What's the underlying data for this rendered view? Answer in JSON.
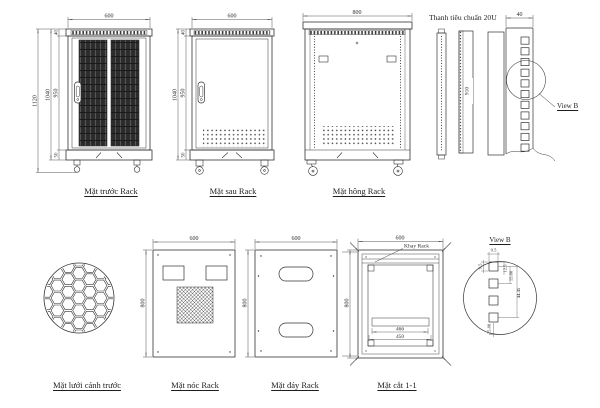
{
  "views": {
    "front": {
      "label": "Mặt trước Rack",
      "dim_width": "600",
      "dim_overall_height": "1120",
      "dim_body_height": "1040",
      "dim_door_height": "950",
      "dim_top_panel": "40",
      "dim_bottom_panel": "50"
    },
    "back": {
      "label": "Mặt sau Rack",
      "dim_width": "600",
      "dim_body_height": "1040",
      "dim_door_height": "950",
      "dim_top_panel": "40",
      "dim_bottom_panel": "50"
    },
    "side": {
      "label": "Mặt hông Rack",
      "dim_depth": "800"
    },
    "rail": {
      "title": "Thanh tiêu chuẩn 20U",
      "dim_flange_width": "40",
      "dim_height": "910",
      "detail_callout": "View B"
    },
    "mesh": {
      "label": "Mặt lưới cánh trước"
    },
    "roof": {
      "label": "Mặt nóc Rack",
      "dim_width": "600",
      "dim_depth": "800"
    },
    "base": {
      "label": "Mặt đáy Rack",
      "dim_width": "600",
      "dim_depth": "800"
    },
    "section": {
      "label": "Mặt cắt 1-1",
      "tray_callout": "Khay Rack",
      "dim_width": "600",
      "dim_depth": "800",
      "dim_rail_outer": "466",
      "dim_rail_inner": "450"
    },
    "detail_b": {
      "title": "View B",
      "dim_hole_width": "9.5",
      "dim_hole_height": "9.5",
      "dim_top_offset": "12.5",
      "dim_hole_pitch": "15.88",
      "dim_u_pitch": "44.45",
      "dim_bottom_pitch": "15.88"
    }
  },
  "colors": {
    "line": "#3a3a3a",
    "background": "#ffffff"
  }
}
